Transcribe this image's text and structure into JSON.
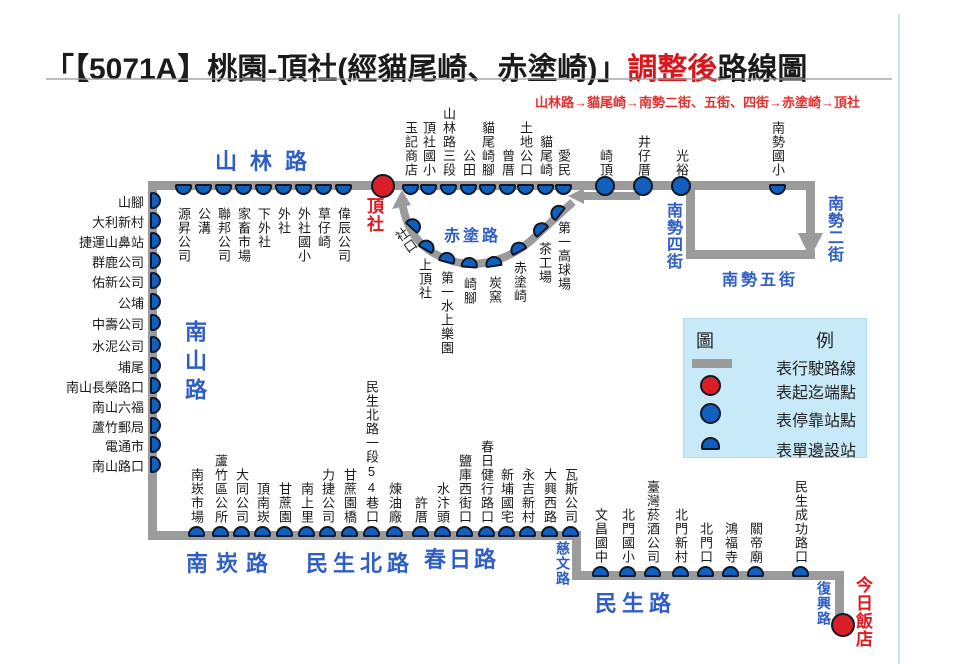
{
  "title": {
    "part1": "「【5071A】桃園-頂社(經貓尾崎、赤塗崎)」",
    "highlight": "調整後",
    "part2": "路線圖"
  },
  "subtitle": "山林路→貓尾崎→南勢二街、五街、四街→赤塗崎→頂社",
  "colors": {
    "route_gray": "#9b9b9b",
    "stop_blue": "#1160bf",
    "stop_outline": "#101826",
    "terminal_red": "#d81e26",
    "road_blue": "#2f5ec4",
    "red_text": "#e01920",
    "legend_bg": "#c8e9f7"
  },
  "route": {
    "lines": [
      {
        "name": "shanlin-road",
        "x": 148,
        "y": 181,
        "w": 667,
        "h": 9
      },
      {
        "name": "nanshan-road",
        "x": 148,
        "y": 181,
        "w": 9,
        "h": 359
      },
      {
        "name": "nankan-chunri",
        "x": 148,
        "y": 531,
        "w": 433,
        "h": 9
      },
      {
        "name": "ciwen-road",
        "x": 572,
        "y": 531,
        "w": 9,
        "h": 49
      },
      {
        "name": "minsheng-road",
        "x": 572,
        "y": 571,
        "w": 272,
        "h": 9
      },
      {
        "name": "fuxing-road",
        "x": 835,
        "y": 571,
        "w": 9,
        "h": 57
      },
      {
        "name": "nanshi-4th-st",
        "x": 686,
        "y": 181,
        "w": 9,
        "h": 77
      },
      {
        "name": "nanshi-5th-st",
        "x": 686,
        "y": 250,
        "w": 129,
        "h": 9
      },
      {
        "name": "nanshi-2nd-st",
        "x": 806,
        "y": 181,
        "w": 9,
        "h": 56
      },
      {
        "name": "west-arrow-shaft",
        "x": 582,
        "y": 192,
        "w": 58,
        "h": 8
      }
    ],
    "curve_path": "M 402 202 C 407 233 422 251 449 260 C 478 270 511 260 536 236 C 551 222 562 212 573 202",
    "arrows": [
      {
        "name": "arrow-up-to-dingshe",
        "points": "402,190 392,209 411,205"
      },
      {
        "name": "arrow-westbound",
        "points": "568,196 584,188 584,204"
      },
      {
        "name": "arrow-southbound",
        "points": "798,233 823,233 810,258"
      }
    ]
  },
  "terminals": [
    {
      "name": "頂社",
      "cx": 383,
      "cy": 186,
      "label_x": 365,
      "label_y": 197
    },
    {
      "name": "今日飯店",
      "cx": 843,
      "cy": 625,
      "label_x": 854,
      "label_y": 576
    }
  ],
  "stop_groups": [
    {
      "id": "shanlin-west",
      "marker": "down",
      "my": 184,
      "label": {
        "mode": "v",
        "anchor": "top",
        "at": 207
      },
      "stops": [
        {
          "name": "源昇公司",
          "x": 183
        },
        {
          "name": "公溝",
          "x": 203
        },
        {
          "name": "聯邦公司",
          "x": 223
        },
        {
          "name": "家畜市場",
          "x": 243
        },
        {
          "name": "下外社",
          "x": 263
        },
        {
          "name": "外社",
          "x": 283
        },
        {
          "name": "外社國小",
          "x": 303
        },
        {
          "name": "草仔崎",
          "x": 323
        },
        {
          "name": "偉辰公司",
          "x": 343
        }
      ]
    },
    {
      "id": "shanlin-east",
      "marker": "down",
      "my": 184,
      "label": {
        "mode": "v",
        "anchor": "bottom",
        "at": 177
      },
      "stops": [
        {
          "name": "玉記商店",
          "x": 410
        },
        {
          "name": "頂社國小",
          "x": 428
        },
        {
          "name": "山林路三段",
          "x": 448
        },
        {
          "name": "公田",
          "x": 468
        },
        {
          "name": "貓尾崎腳",
          "x": 487
        },
        {
          "name": "曾厝",
          "x": 507
        },
        {
          "name": "土地公口",
          "x": 525
        },
        {
          "name": "貓尾崎",
          "x": 545
        },
        {
          "name": "愛民",
          "x": 563
        }
      ]
    },
    {
      "id": "shanlin-circles",
      "marker": "circle",
      "my": 186,
      "label": {
        "mode": "v",
        "anchor": "bottom",
        "at": 177
      },
      "stops": [
        {
          "name": "崎頂",
          "x": 605
        },
        {
          "name": "井仔厝",
          "x": 643
        },
        {
          "name": "光裕",
          "x": 681
        }
      ]
    },
    {
      "id": "nanshi-school",
      "marker": "down",
      "my": 184,
      "label": {
        "mode": "v",
        "anchor": "bottom",
        "at": 177
      },
      "stops": [
        {
          "name": "南勢國小",
          "x": 777
        }
      ]
    },
    {
      "id": "nanshan-side",
      "marker": "right",
      "mx": 150,
      "label": {
        "mode": "h",
        "anchor": "right",
        "at": 144
      },
      "stops": [
        {
          "name": "山腳",
          "y": 200
        },
        {
          "name": "大利新村",
          "y": 220
        },
        {
          "name": "捷運山鼻站",
          "y": 240
        },
        {
          "name": "群鹿公司",
          "y": 260
        },
        {
          "name": "佑新公司",
          "y": 280
        },
        {
          "name": "公埔",
          "y": 301
        },
        {
          "name": "中壽公司",
          "y": 322
        },
        {
          "name": "水泥公司",
          "y": 344
        },
        {
          "name": "埔尾",
          "y": 365
        },
        {
          "name": "南山長榮路口",
          "y": 385
        },
        {
          "name": "南山六福",
          "y": 405
        },
        {
          "name": "蘆竹郵局",
          "y": 425
        },
        {
          "name": "電通市",
          "y": 444
        },
        {
          "name": "南山路口",
          "y": 464
        }
      ]
    },
    {
      "id": "chitu-curve",
      "marker": "rot",
      "label": {
        "mode": "v",
        "anchor": "custom"
      },
      "stops": [
        {
          "name": "社口",
          "x": 414,
          "y": 224,
          "rot": 42,
          "lx": 390,
          "ly": 230,
          "lrot": -36
        },
        {
          "name": "上頂社",
          "x": 427,
          "y": 245,
          "rot": 30,
          "lx": 417,
          "ly": 258
        },
        {
          "name": "第一水上樂園",
          "x": 447,
          "y": 257,
          "rot": 14,
          "lx": 439,
          "ly": 271
        },
        {
          "name": "崎腳",
          "x": 469,
          "y": 262,
          "rot": 4,
          "lx": 462,
          "ly": 277
        },
        {
          "name": "炭窯",
          "x": 493,
          "y": 261,
          "rot": -8,
          "lx": 487,
          "ly": 276
        },
        {
          "name": "赤塗崎",
          "x": 517,
          "y": 247,
          "rot": -28,
          "lx": 512,
          "ly": 261
        },
        {
          "name": "茶工場",
          "x": 539,
          "y": 228,
          "rot": -42,
          "lx": 537,
          "ly": 242
        },
        {
          "name": "第一高球場",
          "x": 556,
          "y": 211,
          "rot": -52,
          "lx": 556,
          "ly": 221
        }
      ]
    },
    {
      "id": "bottom-row-1",
      "marker": "up",
      "my": 526,
      "label": {
        "mode": "v",
        "anchor": "bottom",
        "at": 524
      },
      "stops": [
        {
          "name": "南崁市場",
          "x": 196
        },
        {
          "name": "蘆竹區公所",
          "x": 220
        },
        {
          "name": "大同公司",
          "x": 241
        },
        {
          "name": "頂南崁",
          "x": 262
        },
        {
          "name": "甘蔗園",
          "x": 284
        },
        {
          "name": "南上里",
          "x": 306
        },
        {
          "name": "力捷公司",
          "x": 327
        },
        {
          "name": "甘蔗園橋",
          "x": 349
        },
        {
          "name": "民生北路一段54巷口",
          "x": 371
        },
        {
          "name": "煉油廠",
          "x": 394
        },
        {
          "name": "許厝",
          "x": 420
        },
        {
          "name": "水汴頭",
          "x": 442
        },
        {
          "name": "鹽庫西街口",
          "x": 464
        },
        {
          "name": "春日健行路口",
          "x": 486
        },
        {
          "name": "新埔國宅",
          "x": 506
        },
        {
          "name": "永吉新村",
          "x": 527
        },
        {
          "name": "大興西路",
          "x": 549
        },
        {
          "name": "瓦斯公司",
          "x": 570
        }
      ]
    },
    {
      "id": "bottom-row-2",
      "marker": "up",
      "my": 566,
      "label": {
        "mode": "v",
        "anchor": "bottom",
        "at": 564
      },
      "stops": [
        {
          "name": "文昌國中",
          "x": 600
        },
        {
          "name": "北門國小",
          "x": 627
        },
        {
          "name": "臺灣菸酒公司",
          "x": 652
        },
        {
          "name": "北門新村",
          "x": 680
        },
        {
          "name": "北門口",
          "x": 705
        },
        {
          "name": "鴻福寺",
          "x": 730
        },
        {
          "name": "關帝廟",
          "x": 755
        },
        {
          "name": "民生成功路口",
          "x": 800
        }
      ]
    }
  ],
  "roads": [
    {
      "name": "山林路",
      "x": 215,
      "y": 144,
      "mode": "h",
      "size": 22,
      "ls": 13
    },
    {
      "name": "南山路",
      "x": 178,
      "y": 320,
      "mode": "v",
      "size": 22,
      "ls": 7
    },
    {
      "name": "南崁路",
      "x": 186,
      "y": 546,
      "mode": "h",
      "size": 22,
      "ls": 8
    },
    {
      "name": "民生北路",
      "x": 306,
      "y": 546,
      "mode": "h",
      "size": 22,
      "ls": 5
    },
    {
      "name": "春日路",
      "x": 424,
      "y": 542,
      "mode": "h",
      "size": 22,
      "ls": 3
    },
    {
      "name": "民生路",
      "x": 595,
      "y": 586,
      "mode": "h",
      "size": 22,
      "ls": 5
    },
    {
      "name": "赤塗路",
      "x": 444,
      "y": 222,
      "mode": "h",
      "size": 16,
      "ls": 3
    },
    {
      "name": "南勢四街",
      "x": 660,
      "y": 202,
      "mode": "v",
      "size": 16,
      "ls": 1
    },
    {
      "name": "南勢二街",
      "x": 821,
      "y": 195,
      "mode": "v",
      "size": 16,
      "ls": 1
    },
    {
      "name": "南勢五街",
      "x": 722,
      "y": 266,
      "mode": "h",
      "size": 16,
      "ls": 3
    },
    {
      "name": "慈文路",
      "x": 553,
      "y": 541,
      "mode": "v",
      "size": 14,
      "ls": 1
    },
    {
      "name": "復興路",
      "x": 814,
      "y": 581,
      "mode": "v",
      "size": 14,
      "ls": 1
    }
  ],
  "legend": {
    "title_left": "圖",
    "title_right": "例",
    "items": [
      {
        "swatch": "line",
        "label": "表行駛路線"
      },
      {
        "swatch": "circle-red",
        "label": "表起迄端點"
      },
      {
        "swatch": "circle-blue",
        "label": "表停靠站點"
      },
      {
        "swatch": "half-blue",
        "label": "表單邊設站"
      }
    ]
  }
}
